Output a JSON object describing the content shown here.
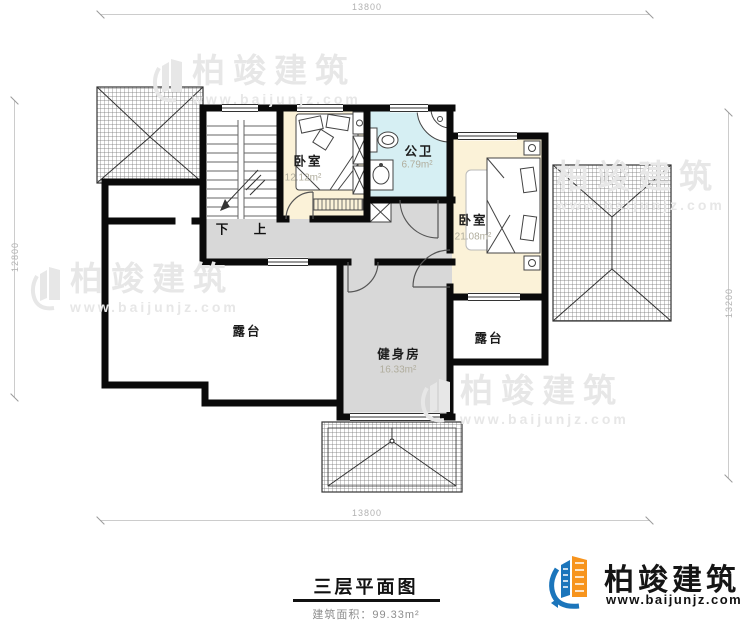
{
  "dimensions": {
    "top": "13800",
    "bottom": "13800",
    "left": "12800",
    "right": "13200"
  },
  "rooms": {
    "bedroom_small": {
      "name": "卧室",
      "area": "12.12m²"
    },
    "bath": {
      "name": "公卫",
      "area": "6.79m²"
    },
    "bedroom_master": {
      "name": "卧室",
      "area": "21.08m²"
    },
    "terrace_left": {
      "name": "露台"
    },
    "terrace_right": {
      "name": "露台"
    },
    "gym": {
      "name": "健身房",
      "area": "16.33m²"
    }
  },
  "stairs": {
    "down": "下",
    "up": "上"
  },
  "title_block": {
    "title": "三层平面图",
    "area": "建筑面积：99.33m²"
  },
  "brand": {
    "name": "柏竣建筑",
    "url": "www.baijunjz.com"
  },
  "watermark": {
    "name": "柏竣建筑",
    "url": "www.baijunjz.com"
  },
  "colors": {
    "wall": "#0a0a0a",
    "bedroom_fill": "#fbf2d8",
    "bath_fill": "#d6eff3",
    "hall_fill": "#d8d8d8",
    "brand_blue": "#1b75bb",
    "brand_orange": "#f7941d"
  }
}
